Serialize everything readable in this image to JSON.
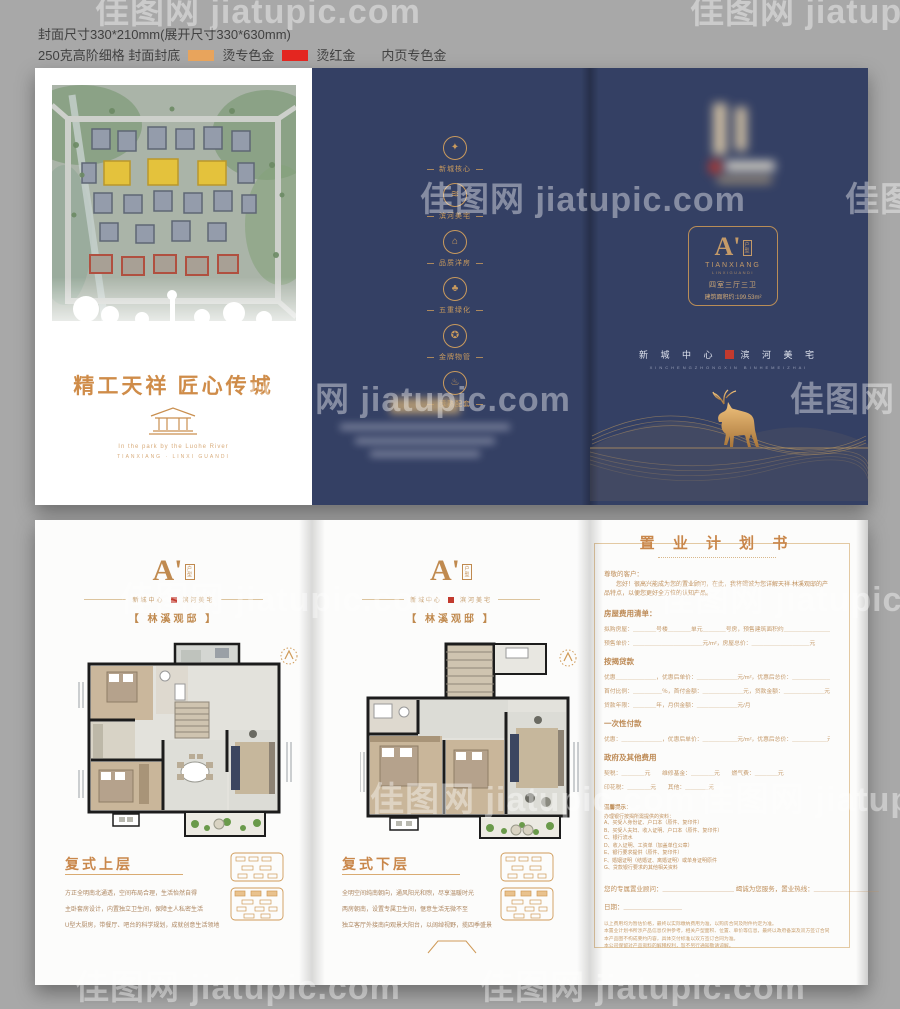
{
  "meta": {
    "spec_line1": "封面尺寸330*210mm(展开尺寸330*630mm)",
    "spec_line2_prefix": "250克高阶细格  封面封底",
    "gold_label": "烫专色金",
    "red_label": "烫红金",
    "spec_line2_suffix": "内页专色金",
    "gold_swatch": "#e8a45c",
    "red_swatch": "#e42620",
    "navy": "#344064",
    "gold": "#c9874b",
    "seal_red": "#c23a2e"
  },
  "watermark": {
    "text": "佳图网 jiatupic.com"
  },
  "cover": {
    "front": {
      "title": "精工天祥 匠心传城",
      "subtitle_en1": "In the park by the Luohe River",
      "subtitle_en2": "TIANXIANG · LINXI GUANDI"
    },
    "back": {
      "features": [
        {
          "icon": "flame-icon",
          "glyph": "✦",
          "label": "新城核心"
        },
        {
          "icon": "mountain-icon",
          "glyph": "≋",
          "label": "滨河美宅"
        },
        {
          "icon": "house-icon",
          "glyph": "⌂",
          "label": "品质洋房"
        },
        {
          "icon": "tree-icon",
          "glyph": "♣",
          "label": "五重绿化"
        },
        {
          "icon": "medal-icon",
          "glyph": "✪",
          "label": "金牌物管"
        },
        {
          "icon": "amenity-icon",
          "glyph": "♨",
          "label": "醇熟配套"
        }
      ]
    },
    "front_panel": {
      "emblem_letter": "A'",
      "emblem_side": "户型",
      "emblem_en1": "TIANXIANG",
      "emblem_en2": "LINXIGUANDI",
      "unit_type": "四室三厅三卫",
      "area": "建筑面积约:199.53m²",
      "slogan_left": "新 城 中 心",
      "slogan_right": "滨 河 美 宅",
      "slogan_en": "XINCHENGZHONGXIN BINHEMEIZHAI"
    }
  },
  "inner": {
    "page_header": {
      "letter": "A'",
      "side": "户型",
      "tagline_left": "新城中心",
      "tagline_right": "滨河美宅",
      "name": "【 林溪观邸 】"
    },
    "upper": {
      "title": "复式上层",
      "lines": [
        "方正全明南北通透，空间布局合理，生活怡然自得",
        "主卧套房设计，内置独立卫生间，保障主人私密生活",
        "U型大厨房，带餐厅、吧台的科学规划，成就创意生活领地"
      ]
    },
    "lower": {
      "title": "复式下层",
      "lines": [
        "全明空间纯南朝向，通风阳光和煦，尽享温暖时光",
        "两房朝南，设置专属卫生间，惬意生活无微不至",
        "独立客厅外接南向观景大阳台，以阔绰视野，揽四季盛景"
      ]
    }
  },
  "form": {
    "title": "置 业 计 划 书",
    "salutation": "尊敬的客户：",
    "intro": "您好！很高兴能成为您的置业顾问，在此，我将竭诚为您详解天祥·林溪观邸的产品特点，以便您更好全方位的认知产品。",
    "sections": [
      {
        "heading": "房屋费用清单：",
        "rows": [
          "拟购房屋：＿＿＿＿号楼＿＿＿＿单元＿＿＿＿号房，预售建筑面积约＿＿＿＿＿＿＿＿m²",
          "预售单价：＿＿＿＿＿＿＿＿＿＿＿＿元/m²，房屋总价：＿＿＿＿＿＿＿＿＿＿元"
        ]
      },
      {
        "heading": "按揭贷款",
        "rows": [
          "优惠＿＿＿＿＿＿＿，优惠后单价：＿＿＿＿＿＿＿元/m²，优惠后总价：＿＿＿＿＿＿＿元",
          "首付比例：＿＿＿＿＿％，首付金额：＿＿＿＿＿＿＿元，贷款金额：＿＿＿＿＿＿＿元",
          "贷款年限：＿＿＿＿年，月供金额：＿＿＿＿＿＿＿元/月"
        ]
      },
      {
        "heading": "一次性付款",
        "rows": [
          "优惠：＿＿＿＿＿＿＿，优惠后单价：＿＿＿＿＿＿元/m²，优惠后总价：＿＿＿＿＿＿元"
        ]
      },
      {
        "heading": "政府及其他费用",
        "rows": [
          "契税：＿＿＿＿元　　维修基金：＿＿＿＿元　　燃气费：＿＿＿＿元",
          "印花税：＿＿＿＿元　　其他：＿＿＿＿元"
        ]
      }
    ],
    "tips_heading": "温馨提示：",
    "tips_sub": "办理银行按揭所需提供的资料：",
    "tips": [
      "A、买受人身份证、户口本（原件、复印件）",
      "B、买受人夫妇、收入证明、户口本（原件、复印件）",
      "C、银行流水",
      "D、收入证明、工资单（加盖单位公章）",
      "E、银行要求提供（原件、复印件）",
      "F、婚姻证明（结婚证、离婚证明）或单身证明原件",
      "G、贷款银行要求的其他相关资料"
    ],
    "advisor_line": "您的专属置业顾问：＿＿＿＿＿＿＿＿＿＿＿ 竭诚为您服务，置业热线：＿＿＿＿＿＿＿＿＿＿",
    "date_line": "日期：＿＿＿＿＿＿＿＿＿",
    "notes": [
      "以上费用均为暂估价格，最终以实际缴纳费用为准，以购房合同及附件约定为准。",
      "本置业计划书所涉产品信息仅供参考，相关户型面积、位置、单价等信息，最终以政府备案及双方签订合同为准。",
      "本产品图不构成要约内容，具体交付标准以双方签订合同为准。",
      "本公司保留对产品资料的解释权利，恕不另行通知敬请谅解。"
    ]
  }
}
